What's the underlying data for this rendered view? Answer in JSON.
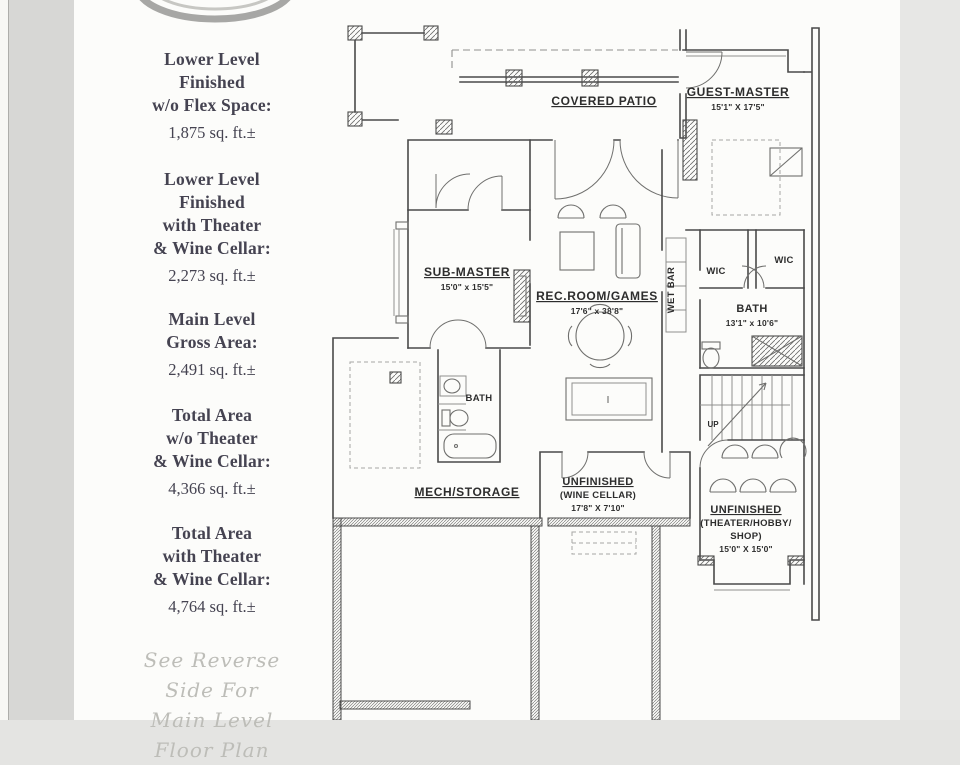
{
  "page": {
    "bg_left": "#d7d7d5",
    "bg_right": "#e7e7e5",
    "paper": "#fcfcfa",
    "ink": "#4a4a4a",
    "stat_text_color": "#454351",
    "note_color": "#bdbdb8"
  },
  "sidebar": {
    "stats": [
      {
        "line1": "Lower Level",
        "line2": "Finished",
        "line3": "w/o Flex Space:",
        "value": "1,875 sq. ft.±"
      },
      {
        "line1": "Lower Level",
        "line2": "Finished",
        "line3": "with Theater",
        "line4": "& Wine Cellar:",
        "value": "2,273 sq. ft.±"
      },
      {
        "line1": "Main Level",
        "line2": "Gross Area:",
        "value": "2,491 sq. ft.±"
      },
      {
        "line1": "Total Area",
        "line2": "w/o Theater",
        "line3": "& Wine Cellar:",
        "value": "4,366 sq. ft.±"
      },
      {
        "line1": "Total Area",
        "line2": "with Theater",
        "line3": "& Wine Cellar:",
        "value": "4,764 sq. ft.±"
      }
    ],
    "note": {
      "line1": "See Reverse",
      "line2": "Side For",
      "line3": "Main Level",
      "line4": "Floor Plan"
    }
  },
  "floorplan": {
    "covered_patio": {
      "name": "COVERED PATIO"
    },
    "guest_master": {
      "name": "GUEST-MASTER",
      "dims": "15'1\" X 17'5\""
    },
    "sub_master": {
      "name": "SUB-MASTER",
      "dims": "15'0\" x 15'5\""
    },
    "rec_room": {
      "name": "REC.ROOM/GAMES",
      "dims": "17'6\" x 38'8\""
    },
    "wet_bar": {
      "name": "WET BAR"
    },
    "wic_left": {
      "name": "WIC"
    },
    "wic_right": {
      "name": "WIC"
    },
    "bath_main": {
      "name": "BATH",
      "dims": "13'1\" x 10'6\""
    },
    "bath_sub": {
      "name": "BATH"
    },
    "stairs": {
      "label": "UP"
    },
    "mech_storage": {
      "name": "MECH/STORAGE"
    },
    "wine_cellar": {
      "name": "UNFINISHED",
      "sub": "(WINE CELLAR)",
      "dims": "17'8\" X 7'10\""
    },
    "theater": {
      "name": "UNFINISHED",
      "sub": "(THEATER/HOBBY/",
      "sub2": "SHOP)",
      "dims": "15'0\" X 15'0\""
    }
  }
}
